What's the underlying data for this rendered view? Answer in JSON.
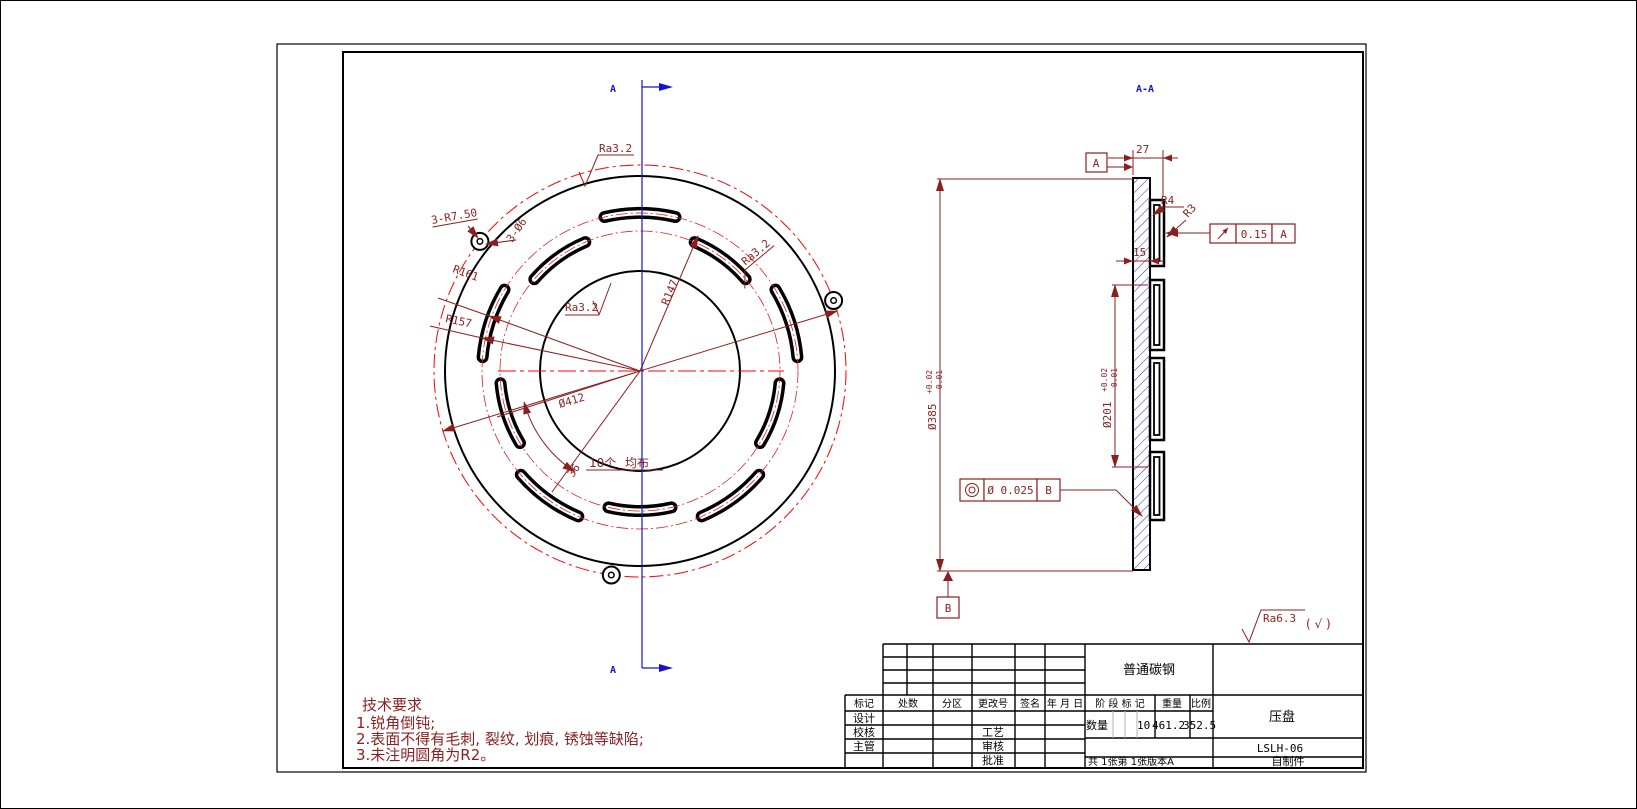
{
  "drawing": {
    "front_view": {
      "section_label_top": "A",
      "section_label_bottom": "A",
      "ra_top": "Ra3.2",
      "ra_mid": "Ra3.2",
      "ra_right": "Ra3.2",
      "r161": "R161",
      "r157": "R157",
      "r147": "R147",
      "dia412": "Ø412",
      "lug_radius": "3-R7.50",
      "lug_hole": "3-Ø6",
      "slot_count": "10个",
      "slot_note": "均布",
      "slot_angle": "36"
    },
    "section_view": {
      "label": "A-A",
      "datum_a": "A",
      "datum_b": "B",
      "dim27": "27",
      "dim15": "15",
      "r4": "R4",
      "r3": "R3",
      "runout_value": "0.15",
      "runout_datum": "A",
      "conc_value": "Ø 0.025",
      "conc_datum": "B",
      "dia385": "Ø385",
      "dia385_tol_up": "+0.02",
      "dia385_tol_dn": "-0.01",
      "dia201": "Ø201",
      "dia201_tol_up": "+0.02",
      "dia201_tol_dn": "-0.01"
    },
    "tech_requirements": {
      "title": "技术要求",
      "item1": "1.锐角倒钝;",
      "item2": "2.表面不得有毛刺, 裂纹, 划痕, 锈蚀等缺陷;",
      "item3": "3.未注明圆角为R2。"
    },
    "surface_note": {
      "ra": "Ra6.3",
      "paren": "( √ )"
    },
    "title_block": {
      "material": "普通碳钢",
      "col_mark": "标记",
      "col_count": "处数",
      "col_zone": "分区",
      "col_change_no": "更改号",
      "col_sign": "签名",
      "col_date": "年 月 日",
      "stage_mark": "阶 段 标 记",
      "weight_label": "重量",
      "scale_label": "比例",
      "qty_label": "数量",
      "qty": "10",
      "weight": "461.2",
      "scale": "352.5",
      "design": "设计",
      "check": "校核",
      "manager": "主管",
      "process": "工艺",
      "review": "审核",
      "approve": "批准",
      "part_name": "压盘",
      "drawing_no": "LSLH-06",
      "sheet_info": "共 1张第 1张版本A",
      "source": "自制件"
    },
    "colors": {
      "dimension": "#8b1f1f",
      "centerline": "#ff0000",
      "section_mark": "#1414cc",
      "hatch": "#2a2ae0",
      "outline": "#000000"
    }
  }
}
